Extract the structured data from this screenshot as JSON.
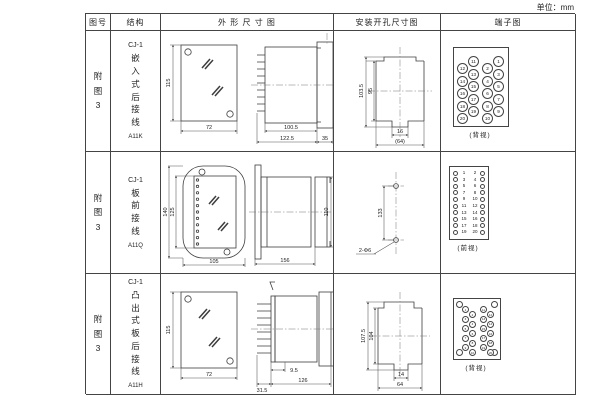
{
  "page": {
    "unit": "单位：mm"
  },
  "header": {
    "fig_no": "图号",
    "structure": "结构",
    "outline": "外 形 尺 寸 图",
    "install": "安装开孔尺寸图",
    "terminal": "端子图"
  },
  "rows": [
    {
      "fig": "附图3",
      "model": "CJ-1",
      "structure_name": "嵌入式后接线",
      "code": "A11K",
      "outline": {
        "height": "115",
        "width": "72",
        "body_len": "100.5",
        "total_len": "122.5",
        "flange": "35"
      },
      "install": {
        "outer_h": "103.5",
        "inner_h": "95",
        "slot_w": "16",
        "outer_w": "(64)"
      },
      "terminal": {
        "caption": "(背视)",
        "cols": [
          [
            "12",
            "14",
            "16",
            "18",
            "20"
          ],
          [
            "11",
            "13",
            "15",
            "17",
            "19"
          ],
          [
            "2",
            "4",
            "6",
            "8",
            "10"
          ],
          [
            "1",
            "3",
            "5",
            "7",
            "9"
          ]
        ]
      }
    },
    {
      "fig": "附图3",
      "model": "CJ-1",
      "structure_name": "板前接线",
      "code": "A11Q",
      "outline": {
        "outer_h": "140",
        "inner_h": "125",
        "width": "105",
        "length": "156",
        "height": "110"
      },
      "install": {
        "spacing": "133",
        "holes": "2-Φ6"
      },
      "terminal": {
        "caption": "(前视)",
        "left": [
          "1",
          "3",
          "5",
          "7",
          "9",
          "11",
          "13",
          "15",
          "17",
          "19"
        ],
        "right": [
          "2",
          "4",
          "6",
          "8",
          "10",
          "12",
          "14",
          "16",
          "18",
          "20"
        ]
      }
    },
    {
      "fig": "附图3",
      "model": "CJ-1",
      "structure_name": "凸出式板后接线",
      "code": "A11H",
      "outline": {
        "height": "115",
        "width": "72",
        "pins_len": "31.5",
        "offset": "9.5",
        "length": "126"
      },
      "install": {
        "outer_h": "107.5",
        "inner_h": "104",
        "slot_w": "14",
        "outer_w": "64"
      },
      "terminal": {
        "caption": "(背视)",
        "left_cols": [
          [
            "1",
            "3",
            "5",
            "7",
            "9"
          ],
          [
            "2",
            "4",
            "6",
            "8",
            "10"
          ]
        ],
        "right_cols": [
          [
            "11",
            "13",
            "15",
            "17",
            "19"
          ],
          [
            "12",
            "14",
            "16",
            "18",
            "20"
          ]
        ]
      }
    }
  ]
}
